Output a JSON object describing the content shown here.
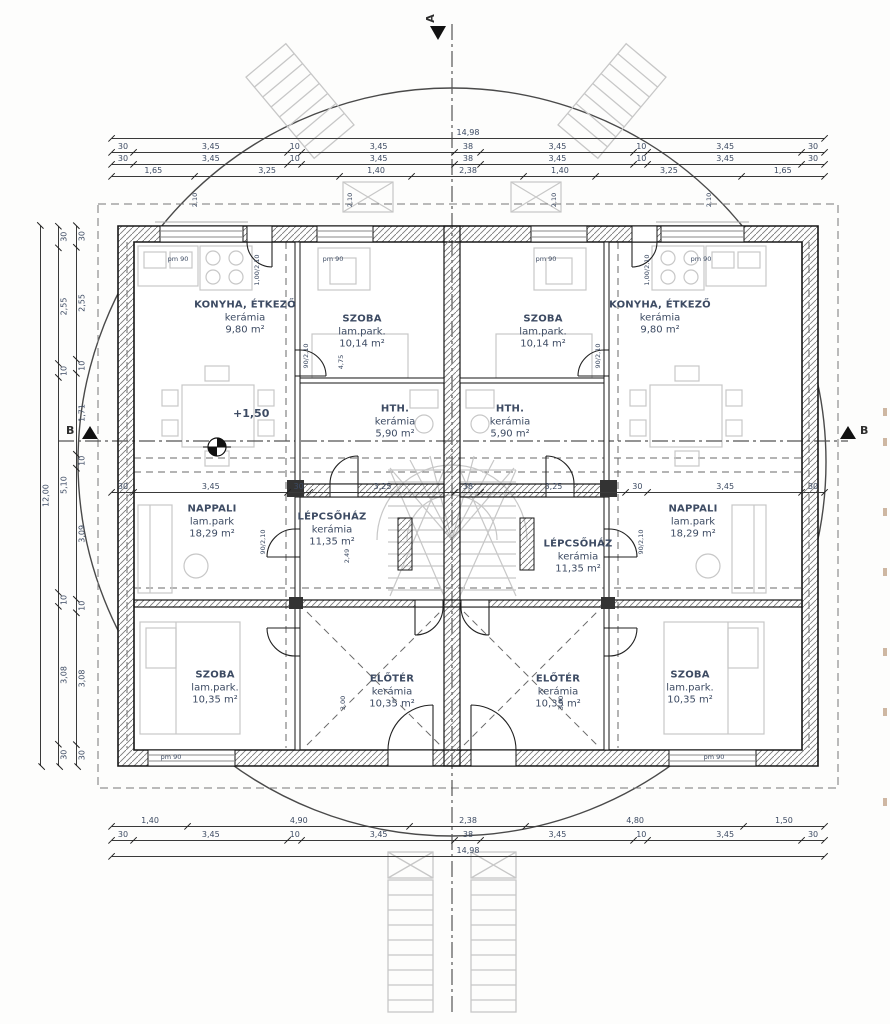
{
  "rooms": {
    "konyha_l": {
      "name": "KONYHA, ÉTKEZŐ",
      "finish": "kerámia",
      "area": "9,80 m²"
    },
    "szoba_tl": {
      "name": "SZOBA",
      "finish": "lam.park.",
      "area": "10,14 m²"
    },
    "szoba_tr": {
      "name": "SZOBA",
      "finish": "lam.park.",
      "area": "10,14 m²"
    },
    "konyha_r": {
      "name": "KONYHA, ÉTKEZŐ",
      "finish": "kerámia",
      "area": "9,80 m²"
    },
    "hth_l": {
      "name": "HTH.",
      "finish": "kerámia",
      "area": "5,90 m²"
    },
    "hth_r": {
      "name": "HTH.",
      "finish": "kerámia",
      "area": "5,90 m²"
    },
    "nappali_l": {
      "name": "NAPPALI",
      "finish": "lam.park",
      "area": "18,29 m²"
    },
    "lepcso_l": {
      "name": "LÉPCSŐHÁZ",
      "finish": "kerámia",
      "area": "11,35 m²"
    },
    "lepcso_r": {
      "name": "LÉPCSŐHÁZ",
      "finish": "kerámia",
      "area": "11,35 m²"
    },
    "nappali_r": {
      "name": "NAPPALI",
      "finish": "lam.park",
      "area": "18,29 m²"
    },
    "eloter_l": {
      "name": "ELŐTÉR",
      "finish": "kerámia",
      "area": "10,35 m²"
    },
    "eloter_r": {
      "name": "ELŐTÉR",
      "finish": "kerámia",
      "area": "10,35 m²"
    },
    "szoba_bl": {
      "name": "SZOBA",
      "finish": "lam.park.",
      "area": "10,35 m²"
    },
    "szoba_br": {
      "name": "SZOBA",
      "finish": "lam.park.",
      "area": "10,35 m²"
    }
  },
  "dimensions": {
    "top_total": "14,98",
    "top_row_outer": [
      "30",
      "3,45",
      "10",
      "3,45",
      "38",
      "3,45",
      "10",
      "3,45",
      "30"
    ],
    "top_row_inner": [
      "30",
      "3,45",
      "10",
      "3,45",
      "38",
      "3,45",
      "10",
      "3,45",
      "30"
    ],
    "top_row_openings": [
      "1,65",
      "3,25",
      "1,40",
      "2,38",
      "1,40",
      "3,25",
      "1,65"
    ],
    "middle_row": [
      "30",
      "3,45",
      "30",
      "3,25",
      "38",
      "3,25",
      "30",
      "3,45",
      "30"
    ],
    "bottom_row_openings": [
      "1,40",
      "4,90",
      "2,38",
      "4,80",
      "1,50"
    ],
    "bottom_row_walls": [
      "30",
      "3,45",
      "10",
      "3,45",
      "38",
      "3,45",
      "10",
      "3,45",
      "30"
    ],
    "bottom_total": "14,98",
    "left_total": "12,00",
    "left_row_mid": [
      "30",
      "2,55",
      "10",
      "5,10",
      "10",
      "3,08",
      "30"
    ],
    "left_row_inner": [
      "30",
      "2,55",
      "10",
      "1,71",
      "10",
      "3,09",
      "10",
      "3,08",
      "30"
    ]
  },
  "section_markers": {
    "top": "A",
    "left": "B",
    "right": "B"
  },
  "annotations": {
    "level": "+1,50",
    "parapet": "pm 90",
    "door_kitchen": "1,00/2,10",
    "door_standard": "90/2,10",
    "hall_length": "4,75",
    "dim_249": "2,49",
    "dim_300": "3,00",
    "window_height": "2,10"
  }
}
